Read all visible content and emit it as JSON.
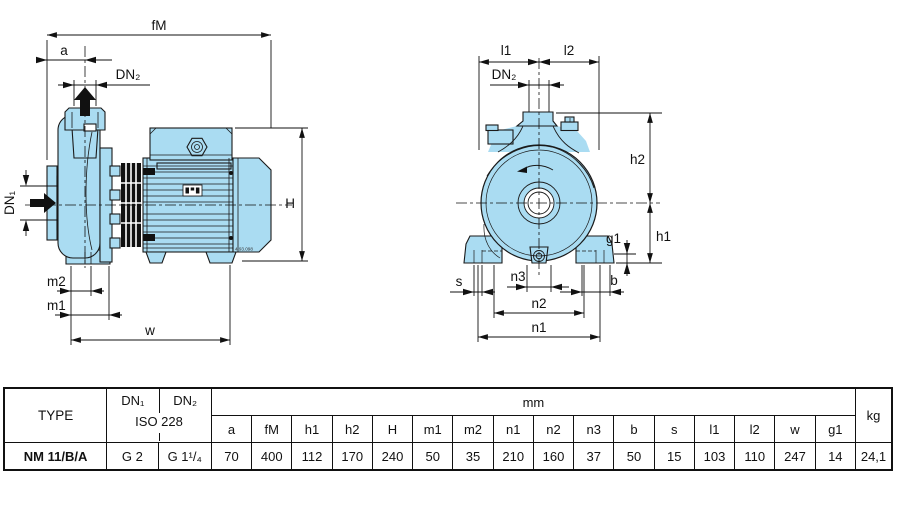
{
  "colors": {
    "pump_fill": "#aadcf2",
    "line_color": "#1a1a1a"
  },
  "side_view": {
    "dims": {
      "fM": "fM",
      "a": "a",
      "dn2": "DN₂",
      "dn1": "DN₁",
      "H": "H",
      "m2": "m2",
      "m1": "m1",
      "w": "w"
    },
    "drawing_number": "4.93.098"
  },
  "front_view": {
    "dims": {
      "l1": "l1",
      "l2": "l2",
      "dn2": "DN₂",
      "h2": "h2",
      "g1": "g1",
      "h1": "h1",
      "s": "s",
      "n3": "n3",
      "b": "b",
      "n2": "n2",
      "n1": "n1"
    }
  },
  "table": {
    "type_header": "TYPE",
    "dn1_header": "DN₁",
    "dn2_header": "DN₂",
    "iso_header": "ISO 228",
    "mm_header": "mm",
    "kg_header": "kg",
    "dim_headers": [
      "a",
      "fM",
      "h1",
      "h2",
      "H",
      "m1",
      "m2",
      "n1",
      "n2",
      "n3",
      "b",
      "s",
      "l1",
      "l2",
      "w",
      "g1"
    ],
    "row": {
      "type": "NM 11/B/A",
      "dn1": "G 2",
      "dn2": "G 1¹/₄",
      "dims": [
        "70",
        "400",
        "112",
        "170",
        "240",
        "50",
        "35",
        "210",
        "160",
        "37",
        "50",
        "15",
        "103",
        "110",
        "247",
        "14"
      ],
      "kg": "24,1"
    }
  }
}
